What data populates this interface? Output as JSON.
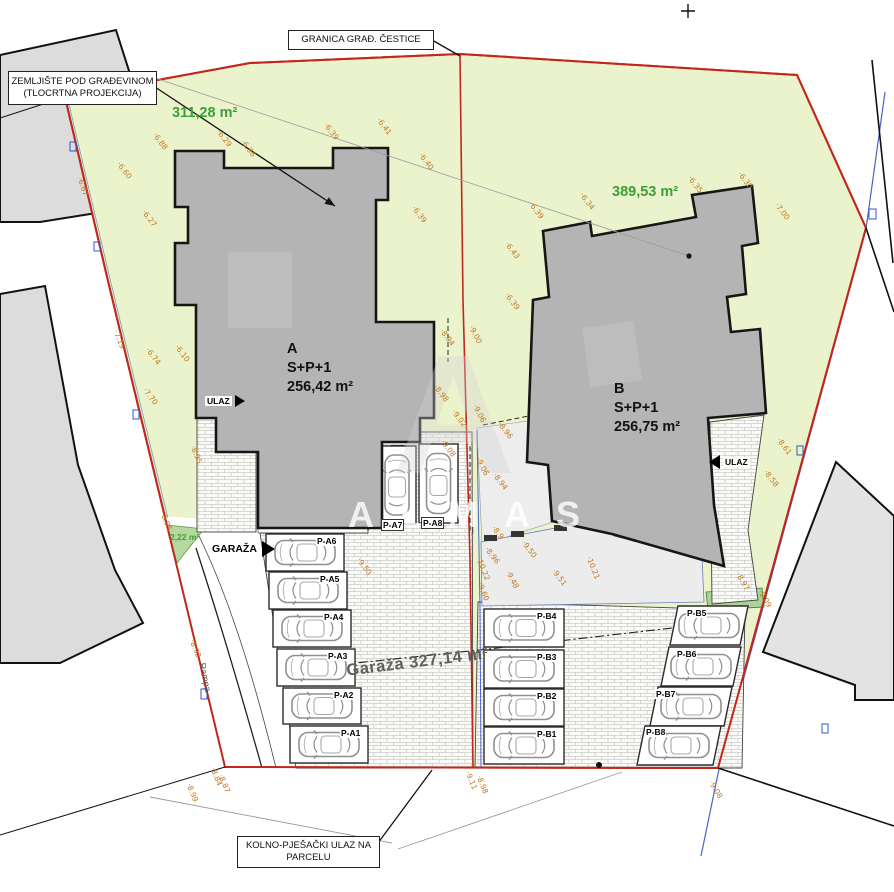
{
  "callouts": {
    "zemljiste": {
      "line1": "ZEMLJIŠTE POD GRAĐEVINOM",
      "line2": "(TLOCRTNA PROJEKCIJA)"
    },
    "granica": {
      "line1": "GRANICA GRAĐ. ČESTICE"
    },
    "kolno": {
      "line1": "KOLNO-PJEŠAČKI ULAZ  NA",
      "line2": "PARCELU"
    }
  },
  "areas": {
    "parcel_a": "311,28 m²",
    "parcel_b": "389,53 m²",
    "green_patch": "2,22 m²",
    "garage_total": "Garaža 327,14 m²"
  },
  "buildings": {
    "a": {
      "name": "A",
      "floors": "S+P+1",
      "area": "256,42 m²"
    },
    "b": {
      "name": "B",
      "floors": "S+P+1",
      "area": "256,75 m²"
    }
  },
  "labels": {
    "garaza": "GARAŽA",
    "ulaz_a": "ULAZ",
    "ulaz_b": "ULAZ",
    "rampa": "Rampa"
  },
  "watermark": {
    "monogram": "A",
    "text": "ALMAS"
  },
  "parking": {
    "stalls": [
      {
        "id": "P-A1",
        "x": 290,
        "y": 726,
        "w": 78,
        "h": 37,
        "dir": "h",
        "lx": 340,
        "ly": 728
      },
      {
        "id": "P-A2",
        "x": 283,
        "y": 688,
        "w": 78,
        "h": 36,
        "dir": "h",
        "lx": 333,
        "ly": 690
      },
      {
        "id": "P-A3",
        "x": 277,
        "y": 649,
        "w": 78,
        "h": 37,
        "dir": "h",
        "lx": 327,
        "ly": 651
      },
      {
        "id": "P-A4",
        "x": 273,
        "y": 610,
        "w": 78,
        "h": 37,
        "dir": "h",
        "lx": 323,
        "ly": 612
      },
      {
        "id": "P-A5",
        "x": 269,
        "y": 572,
        "w": 78,
        "h": 37,
        "dir": "h",
        "lx": 319,
        "ly": 574
      },
      {
        "id": "P-A6",
        "x": 266,
        "y": 534,
        "w": 78,
        "h": 37,
        "dir": "h",
        "lx": 316,
        "ly": 536
      },
      {
        "id": "P-A7",
        "x": 378,
        "y": 446,
        "w": 38,
        "h": 78,
        "dir": "v",
        "lx": 381,
        "ly": 519,
        "boxed": true
      },
      {
        "id": "P-A8",
        "x": 419,
        "y": 444,
        "w": 39,
        "h": 79,
        "dir": "v",
        "lx": 421,
        "ly": 517,
        "boxed": true
      },
      {
        "id": "P-B1",
        "x": 484,
        "y": 727,
        "w": 80,
        "h": 37,
        "dir": "h",
        "lx": 536,
        "ly": 729
      },
      {
        "id": "P-B2",
        "x": 484,
        "y": 689,
        "w": 80,
        "h": 37,
        "dir": "h",
        "lx": 536,
        "ly": 691
      },
      {
        "id": "P-B3",
        "x": 484,
        "y": 650,
        "w": 80,
        "h": 38,
        "dir": "h",
        "lx": 536,
        "ly": 652
      },
      {
        "id": "P-B4",
        "x": 484,
        "y": 609,
        "w": 80,
        "h": 38,
        "dir": "h",
        "lx": 536,
        "ly": 611
      },
      {
        "id": "P-B5",
        "x": 678,
        "y": 606,
        "w": 70,
        "h": 39,
        "dir": "h",
        "lean": -8,
        "lx": 686,
        "ly": 608
      },
      {
        "id": "P-B6",
        "x": 669,
        "y": 647,
        "w": 72,
        "h": 39,
        "dir": "h",
        "lean": -8,
        "lx": 676,
        "ly": 649
      },
      {
        "id": "P-B7",
        "x": 658,
        "y": 687,
        "w": 74,
        "h": 39,
        "dir": "h",
        "lean": -8,
        "lx": 655,
        "ly": 689
      },
      {
        "id": "P-B8",
        "x": 645,
        "y": 726,
        "w": 76,
        "h": 39,
        "dir": "h",
        "lean": -8,
        "lx": 645,
        "ly": 727
      }
    ]
  },
  "elevations": [
    {
      "v": "6.88",
      "x": 158,
      "y": 131,
      "r": 52
    },
    {
      "v": "6.60",
      "x": 122,
      "y": 160,
      "r": 52
    },
    {
      "v": "6.27",
      "x": 147,
      "y": 208,
      "r": 52
    },
    {
      "v": "6.67",
      "x": 84,
      "y": 176,
      "r": 70
    },
    {
      "v": "6.29",
      "x": 222,
      "y": 128,
      "r": 52
    },
    {
      "v": "6.36",
      "x": 246,
      "y": 138,
      "r": 52
    },
    {
      "v": "6.39",
      "x": 329,
      "y": 121,
      "r": 52
    },
    {
      "v": "6.41",
      "x": 382,
      "y": 116,
      "r": 52
    },
    {
      "v": "6.40",
      "x": 424,
      "y": 151,
      "r": 52
    },
    {
      "v": "6.39",
      "x": 417,
      "y": 204,
      "r": 52
    },
    {
      "v": "6.43",
      "x": 510,
      "y": 240,
      "r": 52
    },
    {
      "v": "6.39",
      "x": 510,
      "y": 291,
      "r": 52
    },
    {
      "v": "6.39",
      "x": 534,
      "y": 200,
      "r": 52
    },
    {
      "v": "6.34",
      "x": 585,
      "y": 191,
      "r": 52
    },
    {
      "v": "6.35",
      "x": 693,
      "y": 174,
      "r": 52
    },
    {
      "v": "6.30",
      "x": 743,
      "y": 170,
      "r": 52
    },
    {
      "v": "7.00",
      "x": 780,
      "y": 201,
      "r": 52
    },
    {
      "v": "7.19",
      "x": 120,
      "y": 329,
      "r": 68
    },
    {
      "v": "6.74",
      "x": 151,
      "y": 346,
      "r": 52
    },
    {
      "v": "6.10",
      "x": 180,
      "y": 343,
      "r": 52
    },
    {
      "v": "7.70",
      "x": 148,
      "y": 386,
      "r": 52
    },
    {
      "v": "8.95",
      "x": 197,
      "y": 444,
      "r": 68
    },
    {
      "v": "8.95",
      "x": 167,
      "y": 511,
      "r": 68
    },
    {
      "v": "9.00",
      "x": 475,
      "y": 324,
      "r": 62
    },
    {
      "v": "8.94",
      "x": 445,
      "y": 327,
      "r": 52
    },
    {
      "v": "8.98",
      "x": 439,
      "y": 383,
      "r": 52
    },
    {
      "v": "9.02",
      "x": 457,
      "y": 408,
      "r": 52
    },
    {
      "v": "9.08",
      "x": 446,
      "y": 438,
      "r": 52
    },
    {
      "v": "9.06",
      "x": 479,
      "y": 403,
      "r": 62
    },
    {
      "v": "8.96",
      "x": 503,
      "y": 420,
      "r": 52
    },
    {
      "v": "9.06",
      "x": 482,
      "y": 456,
      "r": 62
    },
    {
      "v": "8.94",
      "x": 498,
      "y": 471,
      "r": 52
    },
    {
      "v": "8.9",
      "x": 497,
      "y": 524,
      "r": 52
    },
    {
      "v": "8.96",
      "x": 490,
      "y": 545,
      "r": 52
    },
    {
      "v": "9.50",
      "x": 527,
      "y": 539,
      "r": 52
    },
    {
      "v": "9.50",
      "x": 362,
      "y": 556,
      "r": 52
    },
    {
      "v": "10.22",
      "x": 483,
      "y": 556,
      "r": 68
    },
    {
      "v": "9.48",
      "x": 512,
      "y": 569,
      "r": 62
    },
    {
      "v": "9.60",
      "x": 484,
      "y": 581,
      "r": 68
    },
    {
      "v": "9.51",
      "x": 557,
      "y": 567,
      "r": 52
    },
    {
      "v": "10.21",
      "x": 593,
      "y": 555,
      "r": 68
    },
    {
      "v": "8.61",
      "x": 782,
      "y": 436,
      "r": 52
    },
    {
      "v": "8.58",
      "x": 769,
      "y": 468,
      "r": 52
    },
    {
      "v": "8.97",
      "x": 742,
      "y": 571,
      "r": 60
    },
    {
      "v": "9.09",
      "x": 764,
      "y": 588,
      "r": 60
    },
    {
      "v": "9.11",
      "x": 472,
      "y": 770,
      "r": 68
    },
    {
      "v": "8.98",
      "x": 483,
      "y": 774,
      "r": 68
    },
    {
      "v": "8.99",
      "x": 193,
      "y": 782,
      "r": 68
    },
    {
      "v": "8.84",
      "x": 217,
      "y": 766,
      "r": 68
    },
    {
      "v": "8.87",
      "x": 225,
      "y": 773,
      "r": 68
    },
    {
      "v": "8.92",
      "x": 196,
      "y": 638,
      "r": 68
    },
    {
      "v": "9.08",
      "x": 715,
      "y": 779,
      "r": 60
    }
  ],
  "colors": {
    "boundary_red": "#c3271b",
    "parcel_green": "#ebf3cd",
    "accent_blue": "#4a63c8",
    "elevation_orange": "#c07820",
    "building_gray": "#b4b4b4",
    "neighbor_gray": "#dcdcdc",
    "area_text_green": "#3aa135",
    "hedge_green": "#abd396"
  }
}
